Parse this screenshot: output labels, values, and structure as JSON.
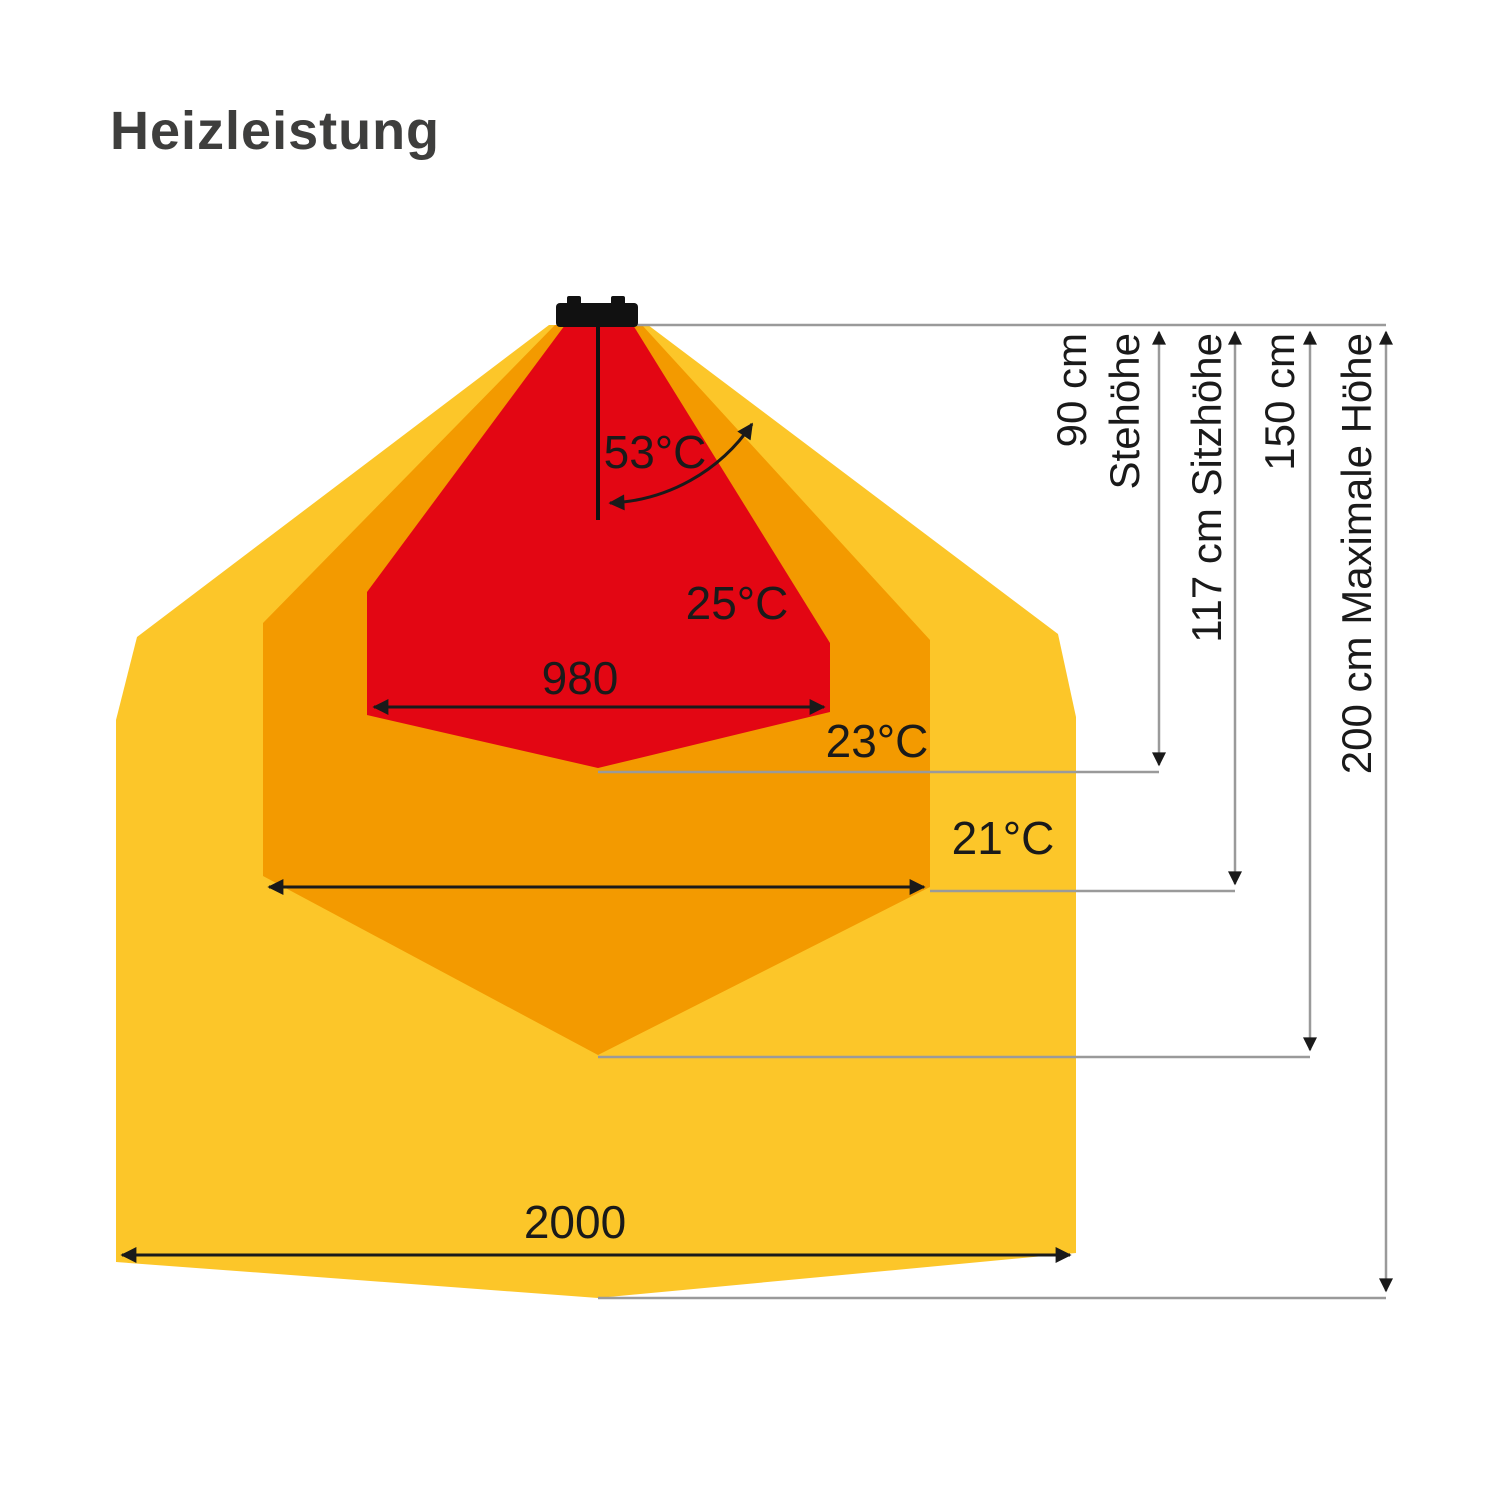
{
  "title": "Heizleistung",
  "colors": {
    "yellow": "#FCC629",
    "orange": "#F39A00",
    "red": "#E30613",
    "ink": "#1A1A1A",
    "gray": "#9A9A9A",
    "title": "#3E3E3D"
  },
  "labels": {
    "angle": "53°C",
    "red_temp": "25°C",
    "red_width": "980",
    "orange_temp": "23°C",
    "yellow_temp": "21°C",
    "yellow_width": "2000"
  },
  "heights": {
    "h90_line1": "90 cm",
    "h90_line2": "Stehöhe",
    "h117": "117 cm Sitzhöhe",
    "h150": "150 cm",
    "h200": "200 cm Maximale Höhe"
  }
}
